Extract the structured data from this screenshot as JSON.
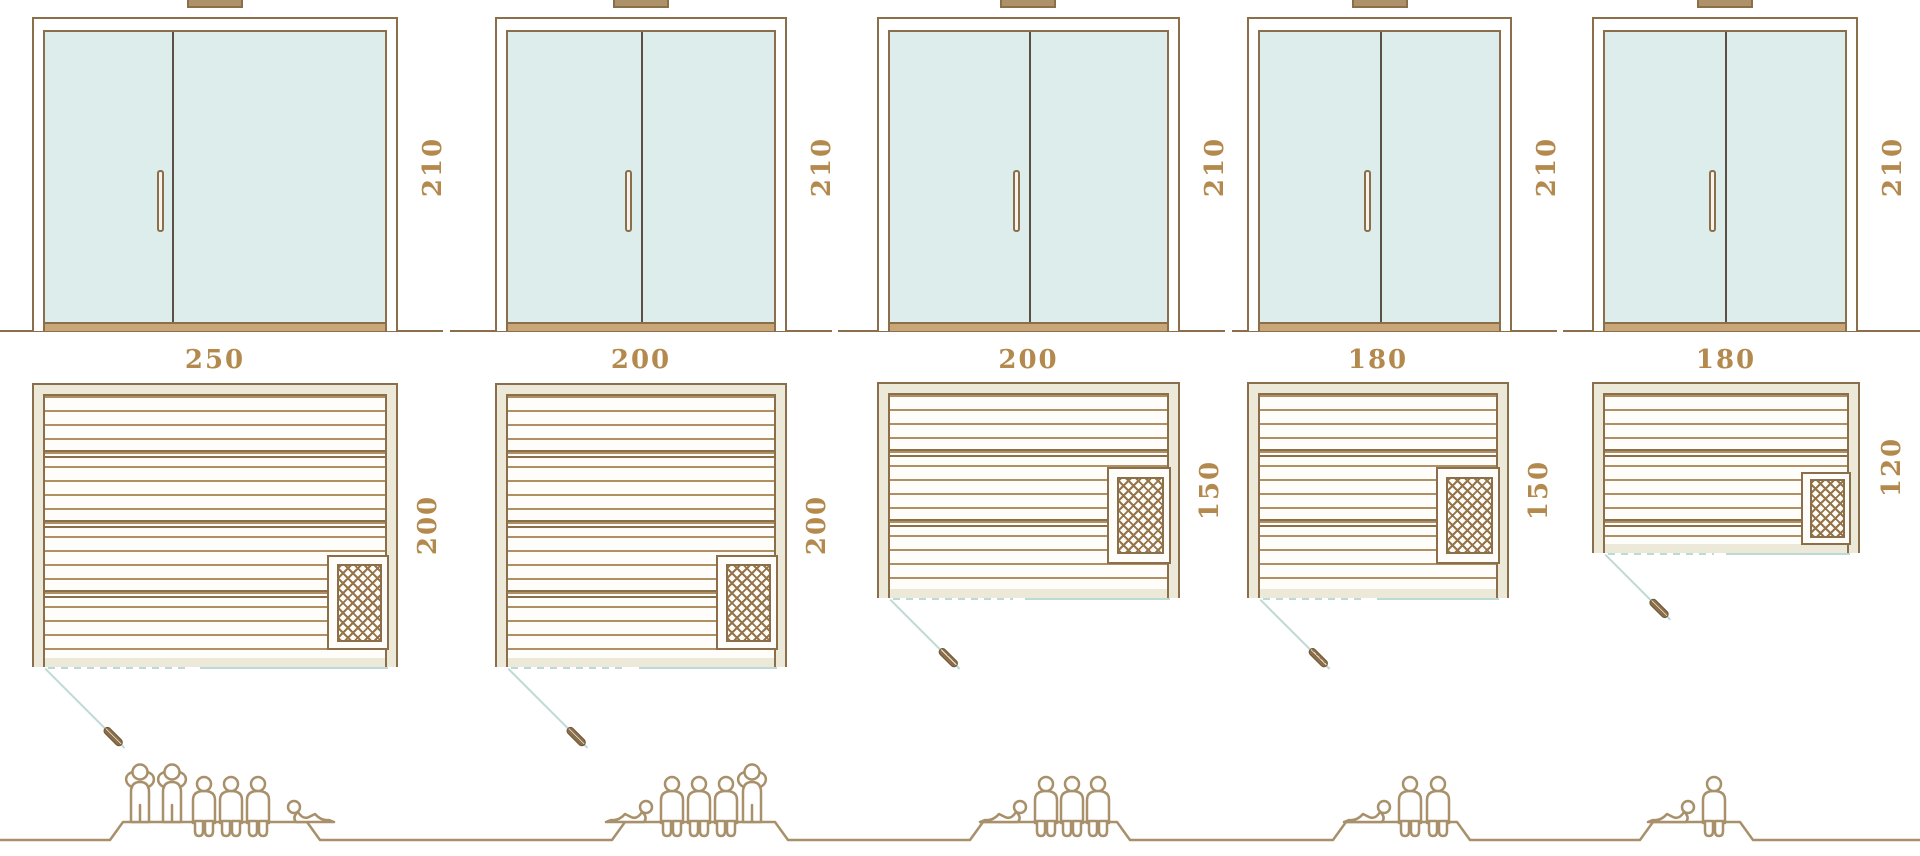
{
  "diagram": "sauna-size-variants",
  "units": [
    {
      "width": "250",
      "depth": "200",
      "door_height": "210",
      "capacity": [
        "standing",
        "standing",
        "seated",
        "seated",
        "seated",
        "lying"
      ],
      "persons": 6
    },
    {
      "width": "200",
      "depth": "200",
      "door_height": "210",
      "capacity": [
        "lying",
        "seated",
        "seated",
        "seated",
        "standing"
      ],
      "persons": 5
    },
    {
      "width": "200",
      "depth": "150",
      "door_height": "210",
      "capacity": [
        "lying",
        "seated",
        "seated",
        "seated"
      ],
      "persons": 4
    },
    {
      "width": "180",
      "depth": "150",
      "door_height": "210",
      "capacity": [
        "lying",
        "seated",
        "seated"
      ],
      "persons": 3
    },
    {
      "width": "180",
      "depth": "120",
      "door_height": "210",
      "capacity": [
        "lying",
        "seated"
      ],
      "persons": 2
    }
  ],
  "colors": {
    "frame_brown": "#8a6f4a",
    "board_tan": "#b08f62",
    "wall_beige": "#ece9d8",
    "glass_mint": "#ddedeb",
    "door_swing_teal": "#bedad4",
    "dimension_gold": "#b3894d",
    "people_tan": "#a8906b"
  }
}
